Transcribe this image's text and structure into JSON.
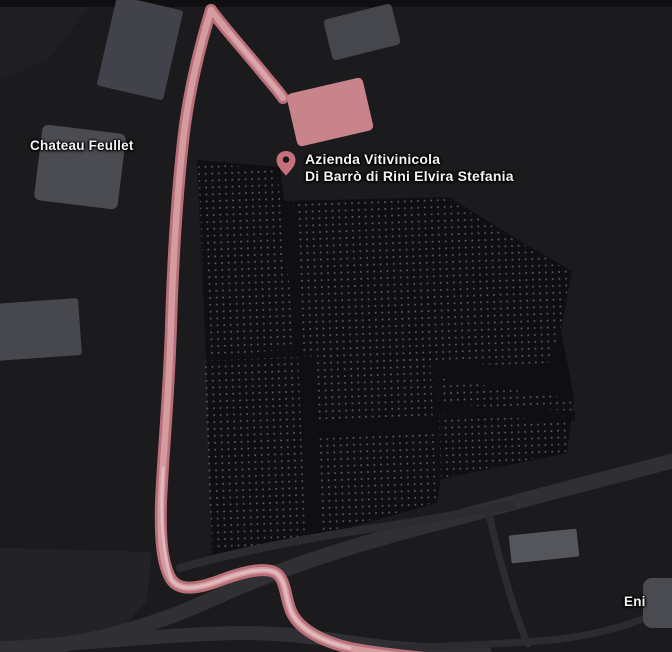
{
  "map": {
    "labels": {
      "winery_line1": "Azienda Vitivinicola",
      "winery_line2": "Di Barrò di Rini Elvira Stefania",
      "chateau": "Chateau Feullet",
      "fuel_station": "Eni"
    },
    "icons": {
      "winery_pin": "map-pin-icon"
    },
    "colors": {
      "background": "#1b1b1e",
      "accent_road_fill": "#d49ba1",
      "accent_road_casing": "#b96f78",
      "accent_road_center": "#e3c2c5",
      "gray_road": "#2f2f34",
      "gray_road_thin": "#2c2c30",
      "building_gray": "#46464d",
      "building_highlight": "#c9838b",
      "pin_fill": "#c4717b",
      "field_base": "#0f0f12",
      "field_dots": "#57575d",
      "label_text": "#f4f4f4"
    }
  }
}
